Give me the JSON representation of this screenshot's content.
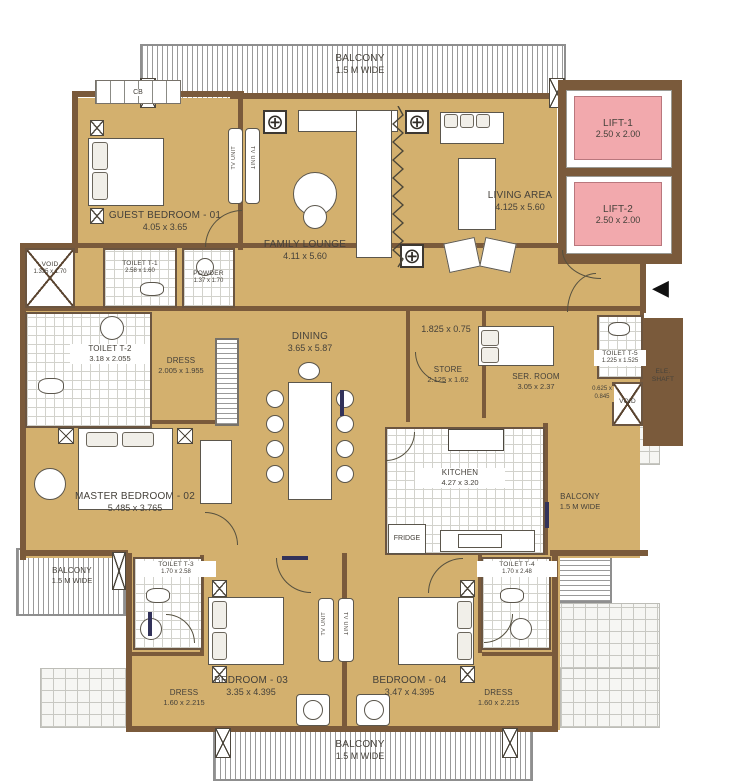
{
  "colors": {
    "floor": "#d3b06e",
    "wall": "#7a5a3b",
    "lift_fill": "#f2a9ad",
    "text": "#45413a"
  },
  "icons": {
    "column": "⊕",
    "entry_arrow": "◀"
  },
  "balconies": {
    "top": {
      "name": "BALCONY",
      "size": "1.5 M WIDE"
    },
    "left": {
      "name": "BALCONY",
      "size": "1.5 M WIDE"
    },
    "right": {
      "name": "BALCONY",
      "size": "1.5 M WIDE"
    },
    "bottom": {
      "name": "BALCONY",
      "size": "1.5 M WIDE"
    }
  },
  "lifts": {
    "lift1": {
      "name": "LIFT-1",
      "dims": "2.50 x 2.00"
    },
    "lift2": {
      "name": "LIFT-2",
      "dims": "2.50 x 2.00"
    }
  },
  "rooms": {
    "guest_bedroom": {
      "name": "GUEST BEDROOM - 01",
      "dims": "4.05 x 3.65"
    },
    "family_lounge": {
      "name": "FAMILY LOUNGE",
      "dims": "4.11 x 5.60"
    },
    "living_area": {
      "name": "LIVING AREA",
      "dims": "4.125 x 5.60"
    },
    "dining": {
      "name": "DINING",
      "dims": "3.65 x 5.87"
    },
    "void_left": {
      "name": "VOID",
      "dims": "1.335 x 1.70"
    },
    "toilet_t1": {
      "name": "TOILET T-1",
      "dims": "2.58 x 1.60"
    },
    "powder": {
      "name": "POWDER",
      "dims": "1.37 x 1.70"
    },
    "toilet_t2": {
      "name": "TOILET T-2",
      "dims": "3.18 x 2.055"
    },
    "dress_master": {
      "name": "DRESS",
      "dims": "2.005 x 1.955"
    },
    "niche": {
      "dims": "1.825 x 0.75"
    },
    "store": {
      "name": "STORE",
      "dims": "2.125 x 1.62"
    },
    "ser_room": {
      "name": "SER. ROOM",
      "dims": "3.05 x 2.37"
    },
    "toilet_t5": {
      "name": "TOILET T-5",
      "dims": "1.225 x 1.525"
    },
    "void_right_dims": {
      "l1": "0.625 x",
      "l2": "0.845"
    },
    "ele_shaft": {
      "l1": "ELE.",
      "l2": "SHAFT"
    },
    "void_small": {
      "name": "VOID"
    },
    "master_bedroom": {
      "name": "MASTER BEDROOM - 02",
      "dims": "5.485 x 3.765"
    },
    "kitchen": {
      "name": "KITCHEN",
      "dims": "4.27 x 3.20"
    },
    "fridge": {
      "name": "FRIDGE"
    },
    "toilet_t3": {
      "name": "TOILET T-3",
      "dims": "1.70 x 2.58"
    },
    "toilet_t4": {
      "name": "TOILET T-4",
      "dims": "1.70 x 2.48"
    },
    "bedroom_03": {
      "name": "BEDROOM - 03",
      "dims": "3.35 x 4.395"
    },
    "bedroom_04": {
      "name": "BEDROOM - 04",
      "dims": "3.47 x 4.395"
    },
    "dress_03": {
      "name": "DRESS",
      "dims": "1.60 x 2.215"
    },
    "dress_04": {
      "name": "DRESS",
      "dims": "1.60 x 2.215"
    },
    "cb": {
      "name": "CB"
    },
    "tv_unit": {
      "name": "TV UNIT"
    }
  }
}
